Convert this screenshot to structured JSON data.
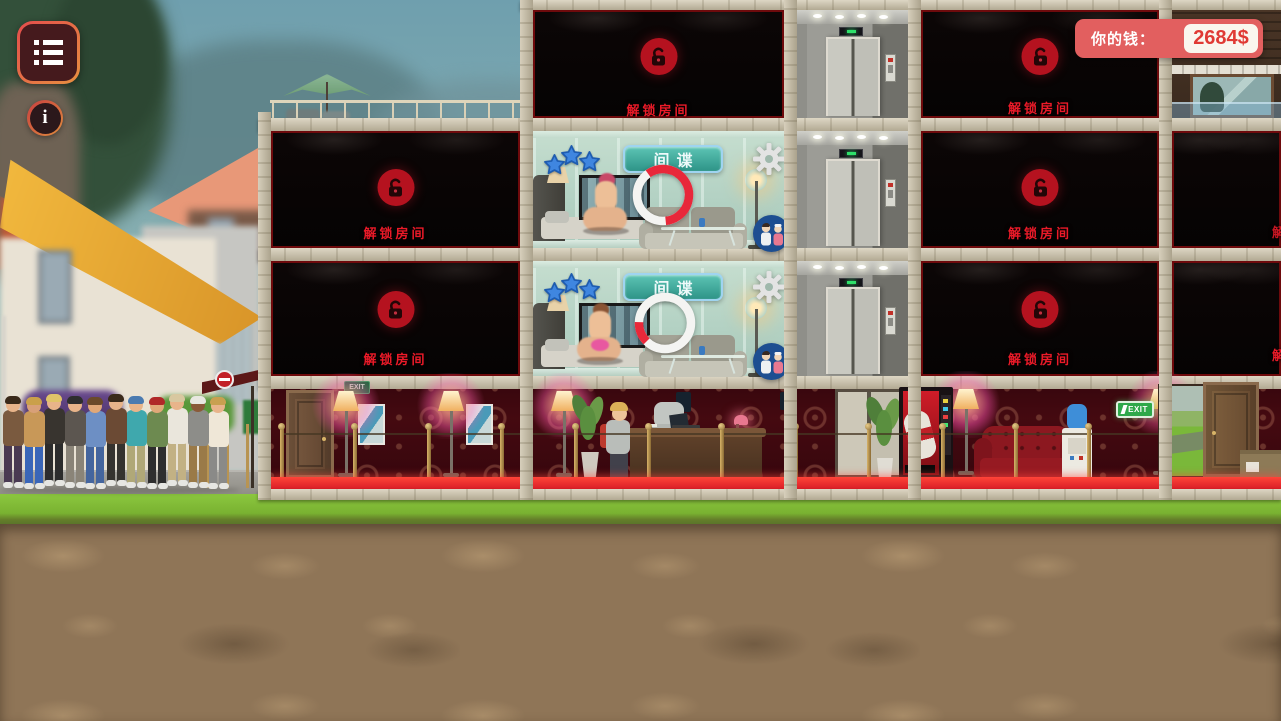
{
  "hud": {
    "menu_button": {
      "icon": "list-menu-icon"
    },
    "info_button": {
      "label": "i"
    },
    "money": {
      "label": "你的钱：",
      "value": "2684$"
    }
  },
  "building": {
    "locked_room_label": "解锁房间",
    "spy_button_label": "间谍",
    "exit_sign_left": "EXIT",
    "exit_sign_right": "EXIT",
    "active_rooms": [
      {
        "floor": 2,
        "stars": 3,
        "progress_percent": 58,
        "arc_start_deg": -125
      },
      {
        "floor": 3,
        "stars": 3,
        "progress_percent": 13,
        "arc_start_deg": 135
      }
    ],
    "locked_room_count": 8,
    "floors": 4
  },
  "scene": {
    "queue_people": [
      {
        "shirt": "#7a5a3f",
        "pants": "#4a3a52",
        "skin": "#e8b48a",
        "hair": "#3a2a1a"
      },
      {
        "shirt": "#c89858",
        "pants": "#3a66b8",
        "skin": "#d8a078",
        "hair": "#caa04a"
      },
      {
        "shirt": "#38342f",
        "pants": "#2c2c2c",
        "skin": "#e8b48a",
        "hair": "#e0c468"
      },
      {
        "shirt": "#5c5650",
        "pants": "#8a8478",
        "skin": "#e8b48a",
        "hair": "#2e2e2e"
      },
      {
        "shirt": "#6d8fc4",
        "pants": "#44659e",
        "skin": "#e0a878",
        "hair": "#6a4a2a"
      },
      {
        "shirt": "#6b4a34",
        "pants": "#35332f",
        "skin": "#e8b48a",
        "hair": "#3a2a1a"
      },
      {
        "shirt": "#3fa8ad",
        "pants": "#b0a878",
        "skin": "#e8b48a",
        "hair": "#4a7ab0"
      },
      {
        "shirt": "#6d8a50",
        "pants": "#2e2e2e",
        "skin": "#e0a878",
        "hair": "#b02828"
      },
      {
        "shirt": "#eae6dc",
        "pants": "#c2b184",
        "skin": "#e8b48a",
        "hair": "#d8c8a0"
      },
      {
        "shirt": "#8d8d89",
        "pants": "#9a7a48",
        "skin": "#8a5a38",
        "hair": "#e8e8e0"
      },
      {
        "shirt": "#efe7d7",
        "pants": "#8a8a88",
        "skin": "#e8b48a",
        "hair": "#c8a050"
      }
    ],
    "stanchion_count": 13,
    "terrace_rail_posts": 11
  },
  "colors": {
    "money-bg": "#e25f5f",
    "money-value": "#e03a34",
    "locked-red": "#ea1a28",
    "lock-circle": "#b5121f",
    "spy-teal-1": "#5cc4b4",
    "spy-teal-2": "#2e9488",
    "spy-border": "#9fd4f0",
    "star-blue": "#3f86e0",
    "star-edge": "#1e5cb0",
    "badge-blue": "#1d4e91",
    "progress-red": "#e8283a",
    "carpet-red": "#d21724",
    "exit-green": "#2ea84a",
    "hud-border-1": "#e34c4c",
    "hud-border-2": "#e89040"
  }
}
